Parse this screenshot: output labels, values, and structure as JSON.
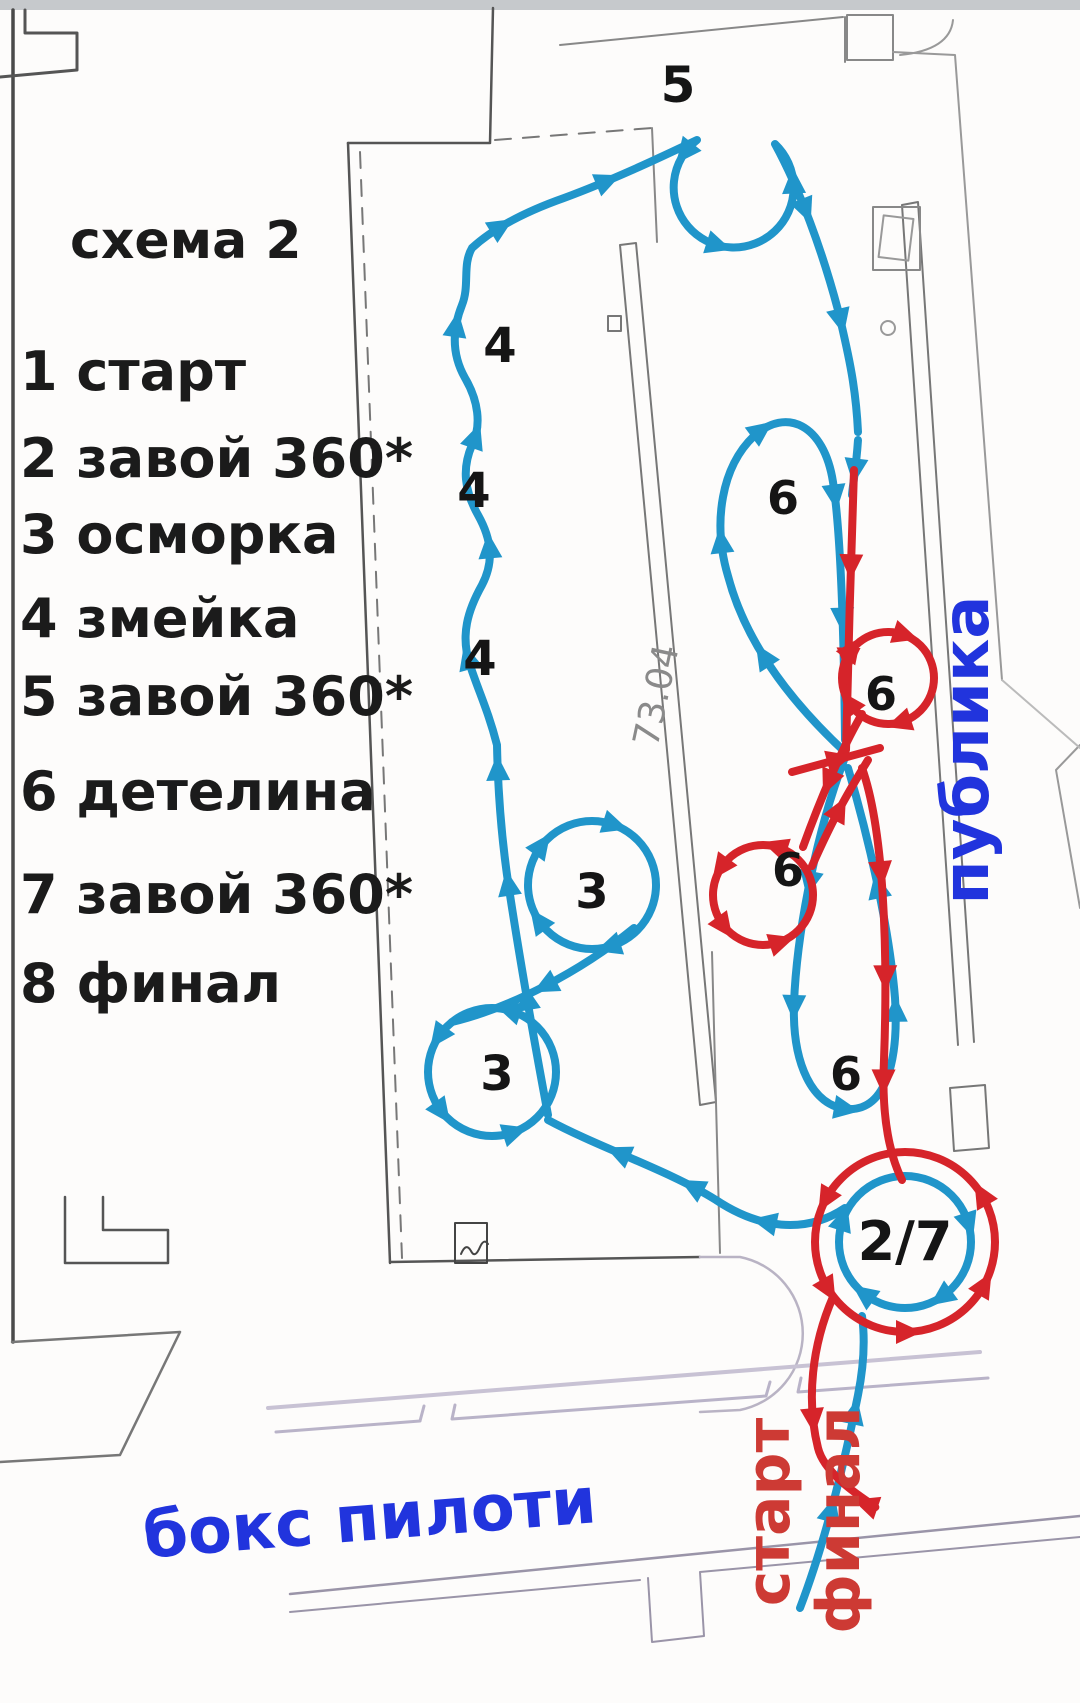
{
  "diagram": {
    "title": "схема 2",
    "legend": [
      "1  старт",
      "2 завой 360*",
      "3 осморка",
      "4 змейка",
      "5 завой 360*",
      "6 детелина",
      "7 завой 360*",
      "8 финал"
    ],
    "markers": {
      "loop5": "5",
      "snake1": "4",
      "snake2": "4",
      "snake3": "4",
      "eight_upper": "3",
      "eight_lower": "3",
      "clover_top": "6",
      "clover_right": "6",
      "clover_left": "6",
      "clover_bottom": "6",
      "turn27": "2/7"
    },
    "labels": {
      "audience": "публика",
      "pilots_box": "бокс пилоти",
      "start": "старт",
      "finish": "финал",
      "dimension": "73.04"
    },
    "colors": {
      "route_first_half_blue": "#2095ca",
      "route_second_half_red": "#d6242a",
      "marker_text": "#151515",
      "annotation_blue": "#2134dd",
      "annotation_red": "#cd3a34",
      "floorplan_dark": "#555555",
      "floorplan_light": "#c3bdd0"
    }
  }
}
